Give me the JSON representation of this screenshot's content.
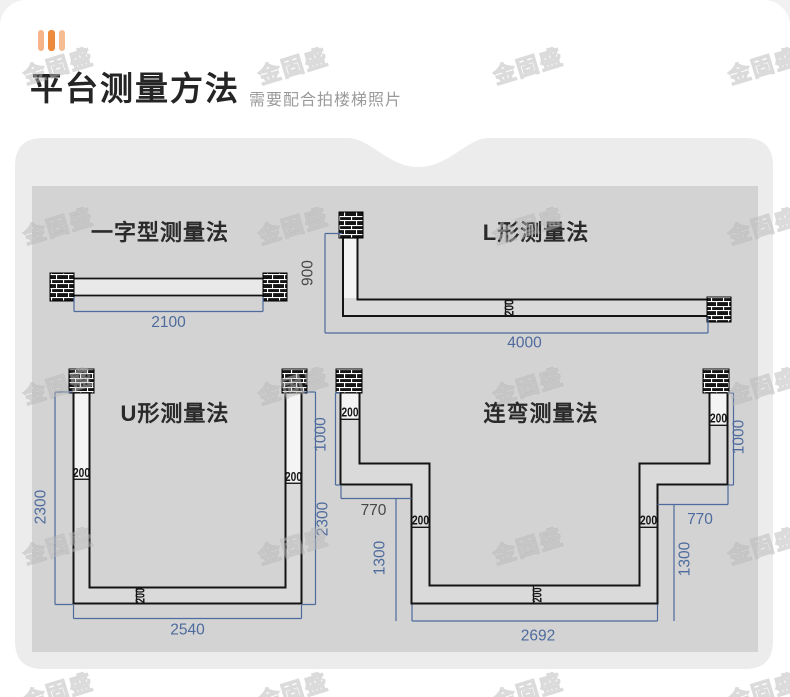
{
  "header": {
    "title": "平台测量方法",
    "subtitle": "需要配合拍楼梯照片",
    "decoration": "three-bars-icon",
    "accent_color": "#ed8a3c"
  },
  "watermark": {
    "text": "金固盛",
    "columns": [
      60,
      295,
      530,
      765
    ],
    "rows": [
      65,
      225,
      385,
      545,
      690
    ]
  },
  "colors": {
    "dim_blue": "#4e6b9d",
    "dim_gray": "#474747",
    "rail_line": "#141414",
    "panel_outer": "#ececec",
    "panel_inner": "#d3d3d3"
  },
  "diagrams": {
    "straight": {
      "title": "一字型测量法",
      "length": "2100"
    },
    "l_shape": {
      "title": "L形测量法",
      "height": "900",
      "length": "4000",
      "rail": "200"
    },
    "u_shape": {
      "title": "U形测量法",
      "left_height": "2300",
      "right_height": "2300",
      "bottom": "2540",
      "rail": "200"
    },
    "bend": {
      "title": "连弯测量法",
      "left_height": "1000",
      "right_height": "1000",
      "left_step": "770",
      "right_step": "770",
      "left_drop": "1300",
      "right_drop": "1300",
      "bottom": "2692",
      "rail": "200"
    }
  }
}
